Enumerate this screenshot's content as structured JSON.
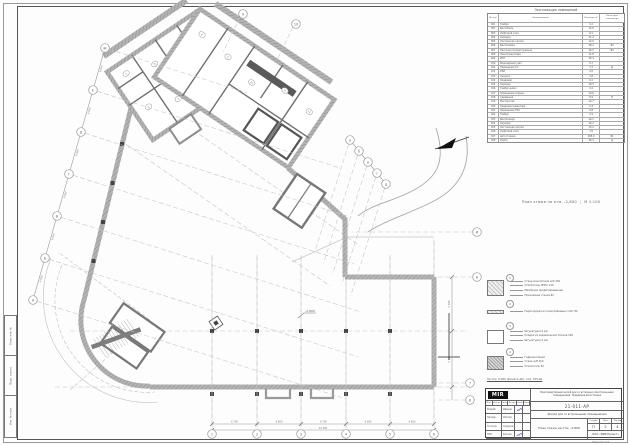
{
  "colors": {
    "accent_signature": "#4553c8",
    "wall_gray": "#ababab",
    "line_gray": "#8a8a8a"
  },
  "plan": {
    "title": "План этажа на отм. -2,800",
    "scale": "М 1:100",
    "elevation_mark": "-2,800",
    "axes": {
      "left": [
        "А",
        "Б",
        "В",
        "Г",
        "Д",
        "Е",
        "Ж"
      ],
      "bottom": [
        "1",
        "2",
        "3",
        "4",
        "5",
        "6"
      ],
      "right": [
        "И",
        "К"
      ],
      "right_lower": [
        "7",
        "8"
      ],
      "diag": [
        "а",
        "б",
        "в",
        "г",
        "д"
      ],
      "top": [
        "9",
        "10"
      ]
    },
    "room_tags_l": [
      "1",
      "2",
      "3",
      "4",
      "5",
      "6",
      "7"
    ],
    "room_tags_r": [
      "8",
      "9",
      "10",
      "11",
      "12"
    ],
    "dimensions": {
      "left": [
        "6 000",
        "6 000",
        "6 000",
        "6 000",
        "6 000",
        "6 000"
      ],
      "bottom": [
        "6 750",
        "6 600",
        "6 750",
        "6 600",
        "6 600"
      ],
      "bottom_total": "33 300",
      "right": [
        "5 400",
        "5 600"
      ]
    }
  },
  "schedule": {
    "title": "Экспликация помещений",
    "columns": [
      "№ пом.",
      "Наименование",
      "Площадь, м²",
      "Категория помещения"
    ],
    "rows": [
      [
        "001",
        "Тамбур",
        "3,2",
        ""
      ],
      [
        "002",
        "Вестибюль",
        "15,6",
        ""
      ],
      [
        "003",
        "Лифтовой холл",
        "8,1",
        ""
      ],
      [
        "004",
        "Коридор",
        "21,4",
        ""
      ],
      [
        "005",
        "Лестничная клетка",
        "12,9",
        ""
      ],
      [
        "006",
        "Венткамера",
        "38,2",
        "В4"
      ],
      [
        "007",
        "Насосная пожаротушения",
        "26,5",
        "В4"
      ],
      [
        "008",
        "Электрощитовая",
        "11,8",
        ""
      ],
      [
        "009",
        "ИТП",
        "30,4",
        ""
      ],
      [
        "010",
        "Водомерный узел",
        "9,7",
        ""
      ],
      [
        "011",
        "Помещение СС",
        "7,2",
        "Д"
      ],
      [
        "012",
        "КУИ",
        "4,5",
        ""
      ],
      [
        "013",
        "Санузел",
        "3,8",
        ""
      ],
      [
        "014",
        "Кладовая",
        "6,1",
        ""
      ],
      [
        "015",
        "Коридор",
        "18,3",
        ""
      ],
      [
        "016",
        "Тамбур-шлюз",
        "4,2",
        ""
      ],
      [
        "017",
        "Помещение охраны",
        "10,6",
        ""
      ],
      [
        "018",
        "Серверная",
        "8,9",
        "В"
      ],
      [
        "019",
        "Мастерская",
        "14,7",
        ""
      ],
      [
        "020",
        "Кладовая инвентаря",
        "5,3",
        ""
      ],
      [
        "021",
        "Помещение ТБО",
        "6,8",
        ""
      ],
      [
        "022",
        "Тамбур",
        "2,9",
        ""
      ],
      [
        "023",
        "Венткамера",
        "24,1",
        ""
      ],
      [
        "024",
        "Коридор",
        "16,2",
        ""
      ],
      [
        "025",
        "Лестничная клетка",
        "13,4",
        ""
      ],
      [
        "026",
        "Лифтовой холл",
        "7,6",
        ""
      ],
      [
        "027",
        "Автостоянка",
        "485,0",
        "В1"
      ],
      [
        "028",
        "Рампа",
        "96,3",
        "Д"
      ]
    ]
  },
  "legend": {
    "items": [
      {
        "num": "1",
        "swatch": "sw-hatch",
        "labels": [
          "Стена монолитная ж/б 250",
          "Утеплитель ЭППС 100",
          "Мембрана профилированная",
          "Прижимная стенка 80"
        ]
      },
      {
        "num": "2",
        "swatch": "sw-hatch",
        "labels": [
          "Перегородка из пазогребневых плит 80"
        ]
      },
      {
        "num": "3",
        "swatch": "sw-empty",
        "labels": [
          "Штукатурка 5 мм",
          "Кладка из керамических блоков 190",
          "Штукатурка 5 мм"
        ]
      },
      {
        "num": "4",
        "swatch": "sw-dark",
        "labels": [
          "Гидроизоляция",
          "Стена ж/б 200",
          "Утеплитель 50"
        ]
      }
    ],
    "note": "За отм. 0,000 принята абс. отм. 155,00"
  },
  "stamp": {
    "logo": "MIR",
    "header_cells": [
      "Изм.",
      "Кол.уч",
      "Лист",
      "№ док.",
      "Подп.",
      "Дата"
    ],
    "sig_rows": [
      {
        "role": "Разраб.",
        "name": "Иванов",
        "signed": true
      },
      {
        "role": "Провер.",
        "name": "Петров",
        "signed": false
      },
      {
        "role": "Н.контр.",
        "name": "Сидоров",
        "signed": false
      },
      {
        "role": "ГИП",
        "name": "Козлов",
        "signed": true
      }
    ],
    "project_text": "Многоквартирный жилой дом со встроенно-пристроенными помещениями. Подземная автостоянка",
    "doc_number": "21-011-АР",
    "object_name": "Жилой дом со встроенными помещениями",
    "sheet_title": "План этажа на отм. -2,800",
    "stage_labels": [
      "Стадия",
      "Лист",
      "Листов"
    ],
    "stage_values": [
      "П",
      "2",
      "4"
    ],
    "org": "ООО «МИР-Проект»"
  },
  "side_stamp": [
    "Взам. инв. №",
    "Подп. и дата",
    "Инв. № подл."
  ],
  "format_note": "Формат А3"
}
